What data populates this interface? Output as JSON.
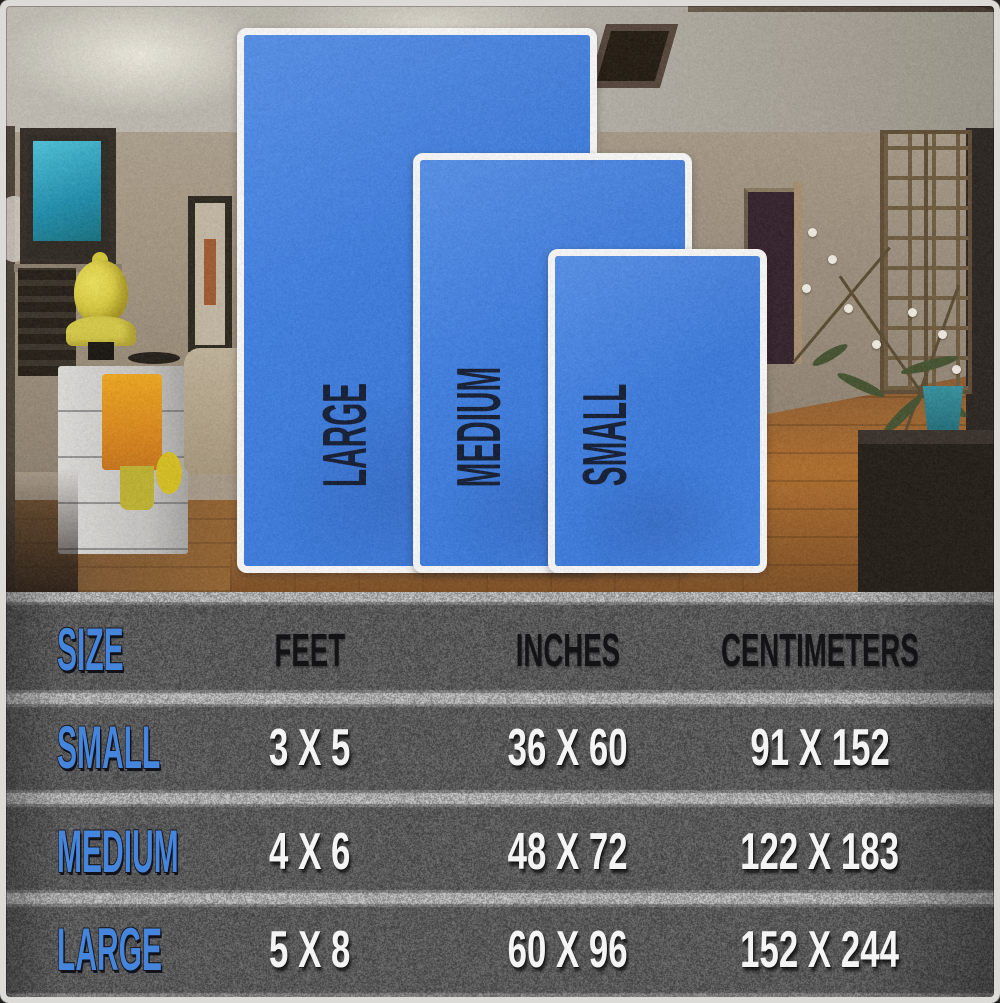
{
  "chart_data": {
    "type": "table",
    "columns": [
      "SIZE",
      "FEET",
      "INCHES",
      "CENTIMETERS"
    ],
    "rows": [
      [
        "SMALL",
        "3 X 5",
        "36 X 60",
        "91 X 152"
      ],
      [
        "MEDIUM",
        "4 X 6",
        "48 X 72",
        "122 X 183"
      ],
      [
        "LARGE",
        "5 X 8",
        "60 X 96",
        "152 X 244"
      ]
    ],
    "accent_color": "#4585dc",
    "header_text_color": "#131315",
    "value_text_color": "#f4f4f4",
    "background": "asphalt-gray-texture"
  },
  "overlay": {
    "rugs": [
      {
        "label": "LARGE"
      },
      {
        "label": "MEDIUM"
      },
      {
        "label": "SMALL"
      }
    ],
    "fill_color": "#3d7fe6",
    "label_color": "#141c33",
    "border_color": "#fafafa"
  }
}
